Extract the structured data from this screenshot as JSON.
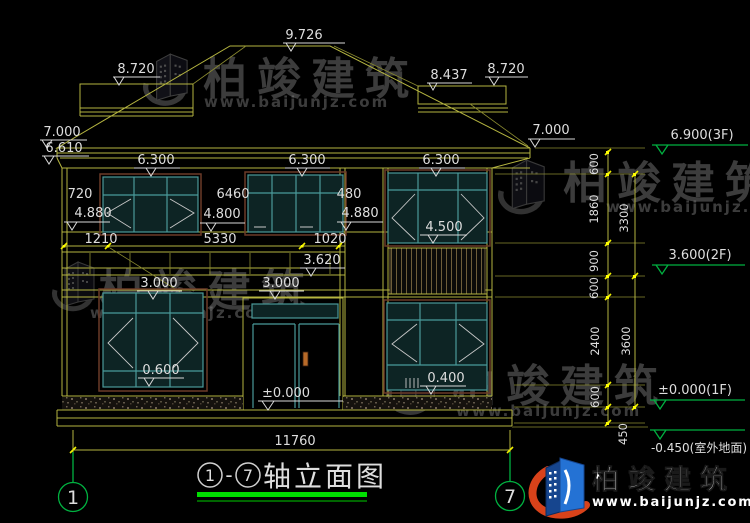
{
  "background": "#000000",
  "colors": {
    "line_yellow": "#b5b540",
    "tick_yellow": "#f0f000",
    "marker_white": "#d8d8d8",
    "level_green": "#00b140",
    "window_teal": "#4a9a9a",
    "frame_maroon": "#6b3a28",
    "title_underline": "#00dd00",
    "logo_blue": "#2068c8",
    "logo_red": "#d8421a",
    "watermark_gray": "#8f8f8f"
  },
  "roof": {
    "ridge_level": "9.726",
    "left_wing_level": "8.720",
    "right_inner_level": "8.437",
    "right_wing_level": "8.720",
    "left_eave_level": "7.000",
    "left_soffit_level": "6.610",
    "right_eave_level": "7.000",
    "eave_levels": [
      "6.300",
      "6.300",
      "6.300"
    ]
  },
  "floor2": {
    "dim_left": "720",
    "dim_center": "6460",
    "dim_right": "480",
    "sill_left": "4.880",
    "sill_center": "4.800",
    "sill_right": "4.880",
    "right_window_level": "4.500"
  },
  "balcony": {
    "dim_segments": [
      "1210",
      "5330",
      "1020"
    ],
    "rail_level": "3.620",
    "floor_levels": [
      "3.000",
      "3.000"
    ]
  },
  "floor1": {
    "sill_left": "0.600",
    "entry_level": "±0.000",
    "sill_right": "0.400"
  },
  "base": {
    "total_width": "11760"
  },
  "right_levels": {
    "l3f": "6.900(3F)",
    "l2f": "3.600(2F)",
    "l1f": "±0.000(1F)",
    "ground": "-0.450(室外地面)"
  },
  "right_chain": {
    "inner": [
      "600",
      "1860",
      "900",
      "600",
      "2400",
      "600",
      "450"
    ],
    "outer": [
      "3300",
      "3600"
    ]
  },
  "axes": {
    "start": "1",
    "end": "7"
  },
  "title": {
    "prefix_dash": "-",
    "name": "轴立面图"
  },
  "watermark": {
    "brand": "柏竣建筑",
    "url": "www.baijunjz.com"
  },
  "logo": {
    "brand": "柏竣建筑",
    "url": "www.baijunjz.com"
  }
}
